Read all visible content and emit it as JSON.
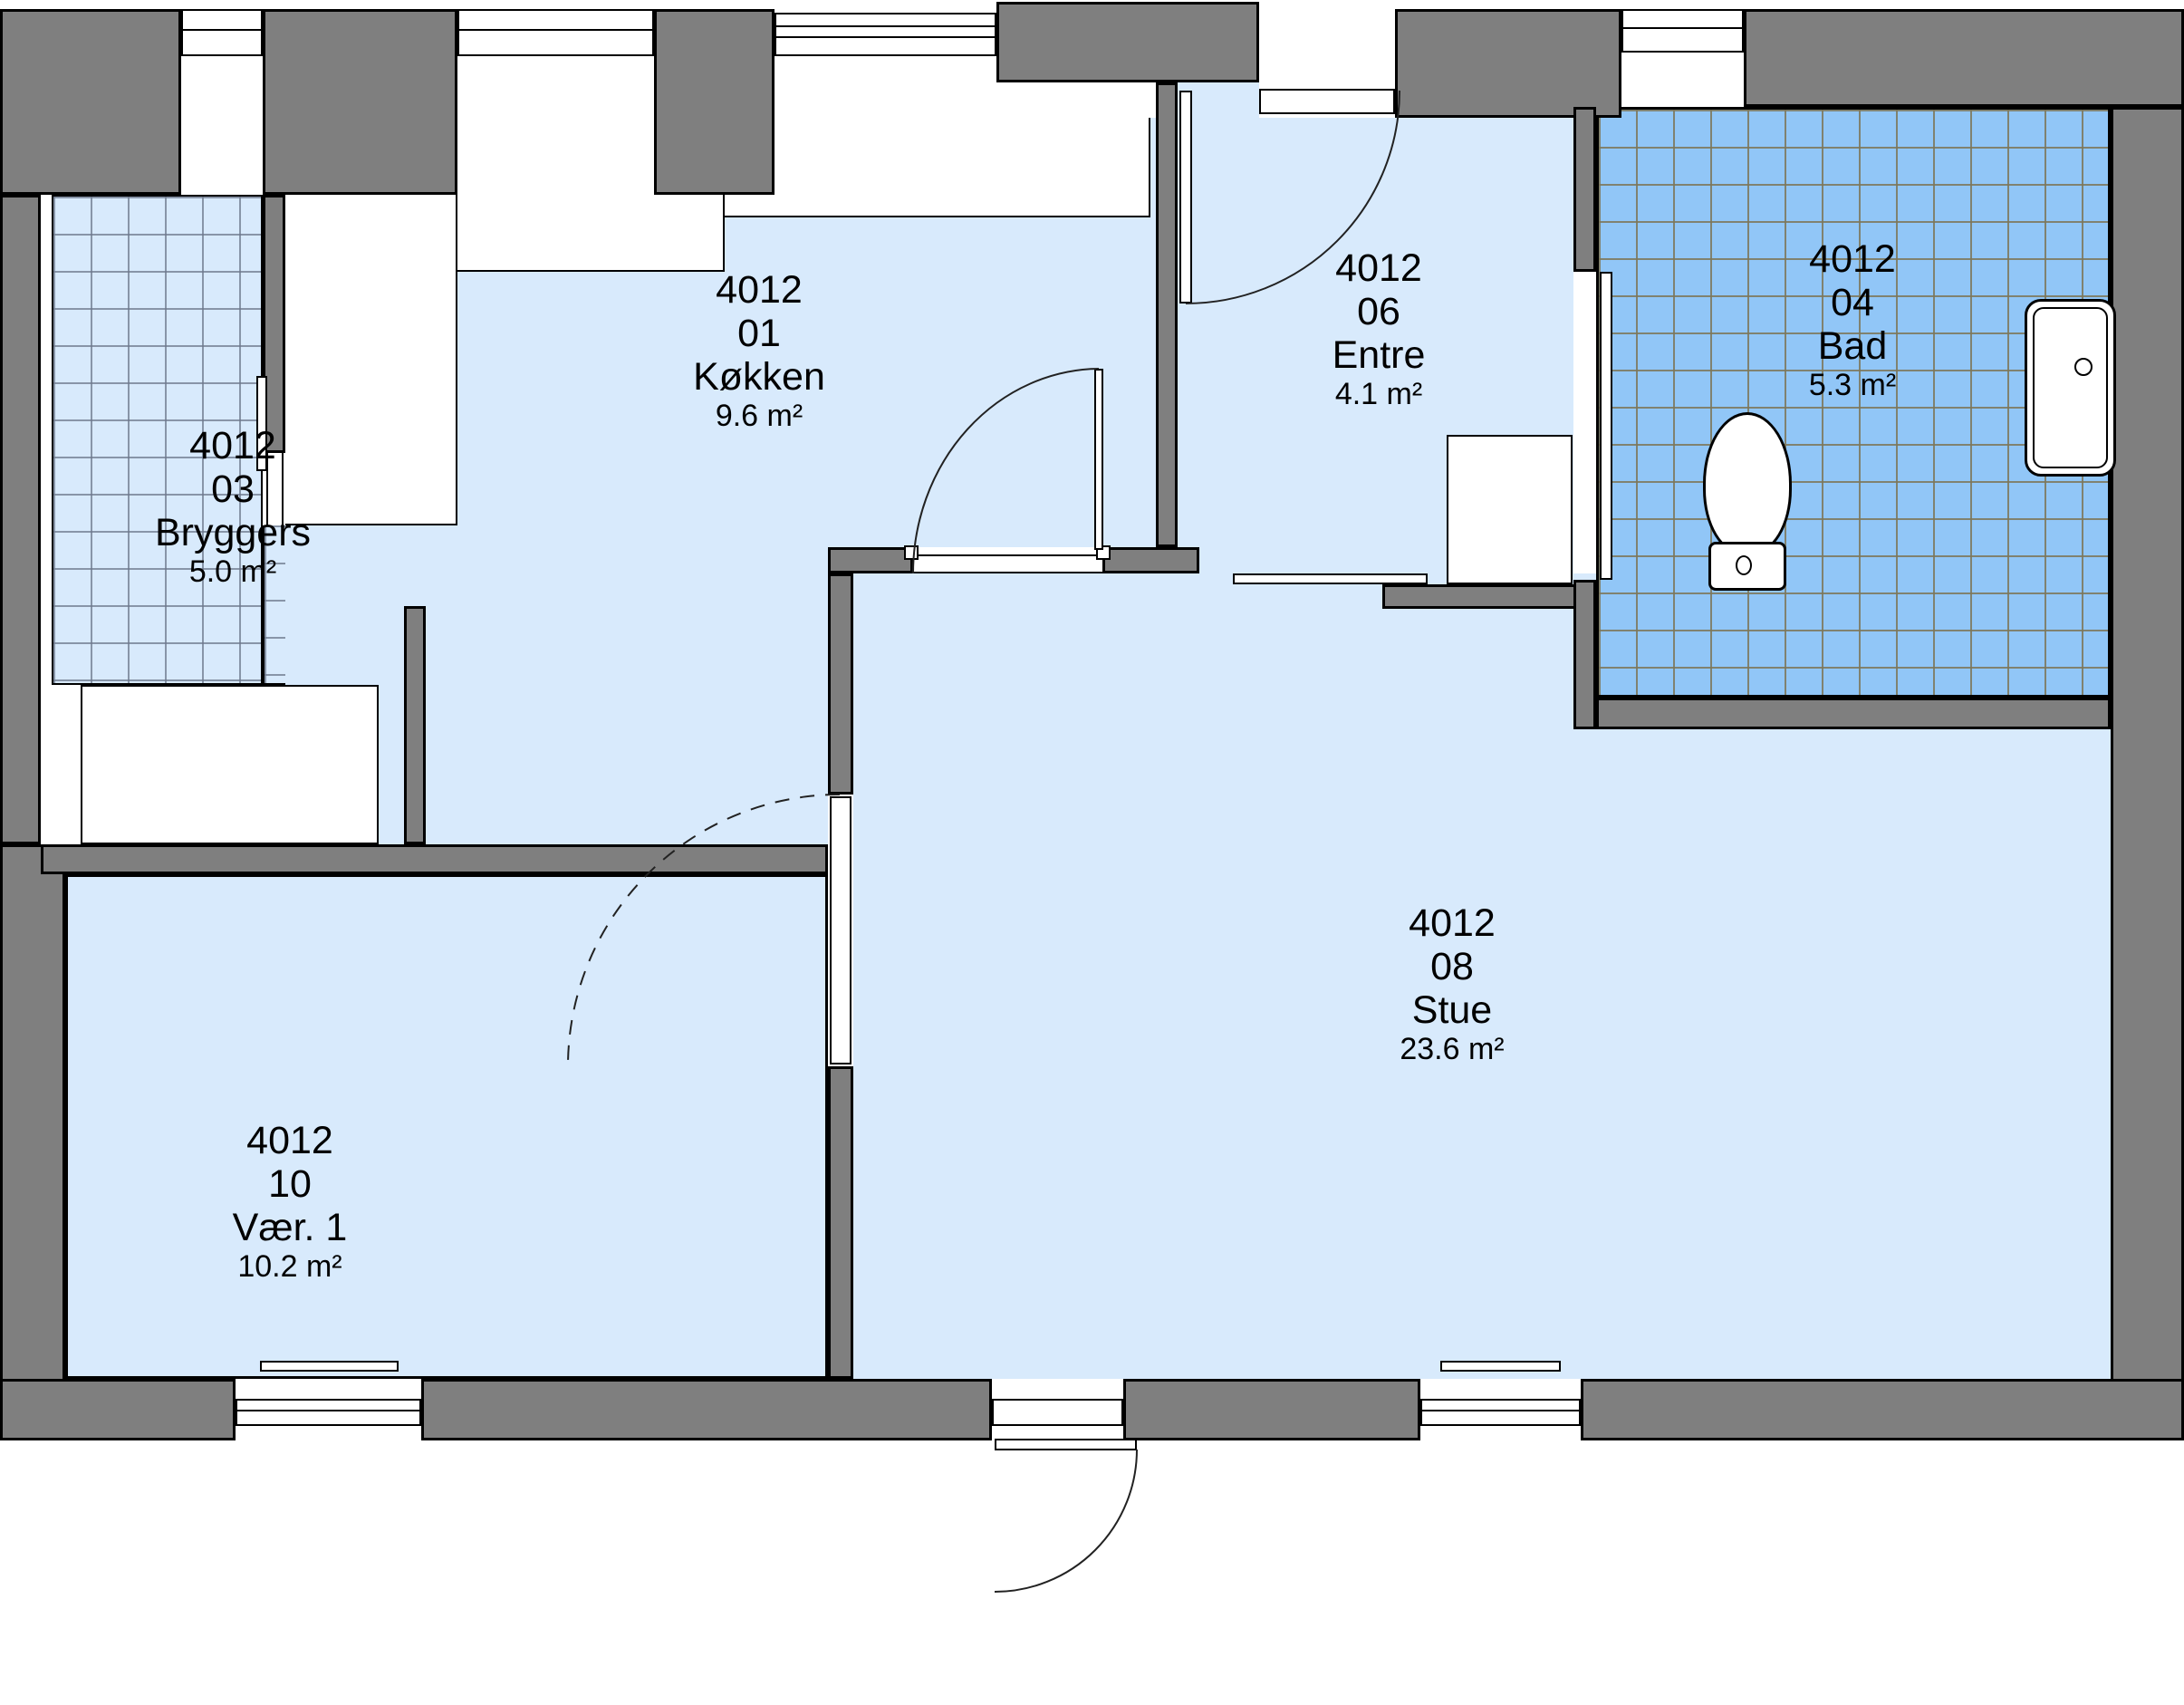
{
  "plan": {
    "unit_number": "4012",
    "rooms": [
      {
        "number": "4012",
        "code": "03",
        "name": "Bryggers",
        "area": "5.0 m²"
      },
      {
        "number": "4012",
        "code": "01",
        "name": "Køkken",
        "area": "9.6 m²"
      },
      {
        "number": "4012",
        "code": "06",
        "name": "Entre",
        "area": "4.1 m²"
      },
      {
        "number": "4012",
        "code": "04",
        "name": "Bad",
        "area": "5.3 m²"
      },
      {
        "number": "4012",
        "code": "08",
        "name": "Stue",
        "area": "23.6 m²"
      },
      {
        "number": "4012",
        "code": "10",
        "name": "Vær. 1",
        "area": "10.2 m²"
      }
    ],
    "colors": {
      "wall_gray": "#7f7f7f",
      "room_fill": "#d8eafc",
      "bathroom_tile_fill": "#91c6f7",
      "outline": "#000000",
      "background": "#ffffff"
    },
    "fixtures": [
      "kitchen-counter",
      "washer-bench",
      "wardrobe",
      "toilet",
      "shower-tray"
    ]
  }
}
